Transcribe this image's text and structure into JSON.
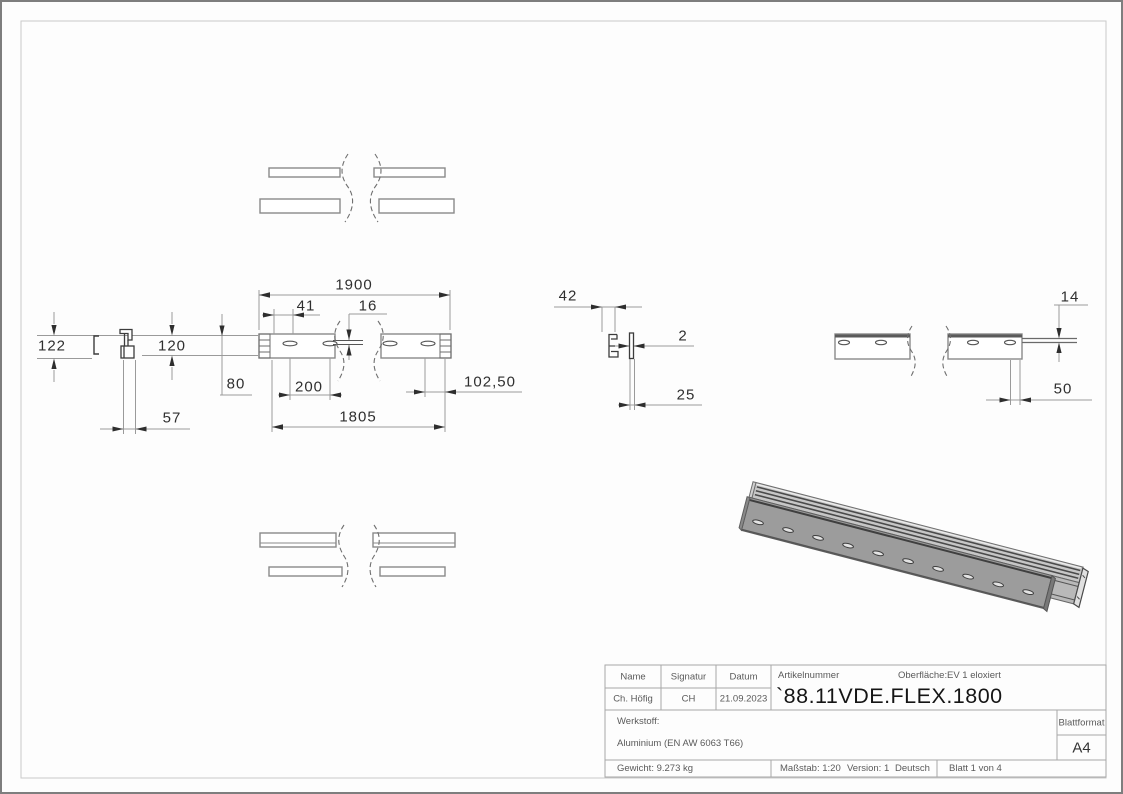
{
  "sheet": {
    "dimensions": {
      "overall_length": "1900",
      "hole_offset": "41",
      "slot_width": "16",
      "total_height": "122",
      "profile_height": "120",
      "depth_80": "80",
      "width_57": "57",
      "hole_spacing": "200",
      "hole_span": "1805",
      "end_distance": "102,50",
      "section_width": "42",
      "thickness": "2",
      "width_25": "25",
      "height_14": "14",
      "width_50": "50"
    },
    "title_block": {
      "name_label": "Name",
      "signature_label": "Signatur",
      "date_label": "Datum",
      "name": "Ch. Höfig",
      "signature": "CH",
      "date": "21.09.2023",
      "article_label": "Artikelnummer",
      "surface_label": "Oberfläche:",
      "surface_value": "EV 1 eloxiert",
      "article_number": "`88.11VDE.FLEX.1800",
      "material_label": "Werkstoff:",
      "material": "Aluminium (EN AW 6063 T66)",
      "sheet_format_label": "Blattformat",
      "sheet_format": "A4",
      "weight": "Gewicht: 9.273 kg",
      "scale": "Maßstab: 1:20",
      "version": "Version: 1",
      "language": "Deutsch",
      "sheet_info": "Blatt 1 von 4"
    },
    "colors": {
      "line_gray": "#8f8f8f",
      "dark_line": "#3c3c3c",
      "frame_gray": "#c9c9c9",
      "table_gray": "#a8a8a8",
      "metal_face": "#9c9c9c"
    }
  }
}
